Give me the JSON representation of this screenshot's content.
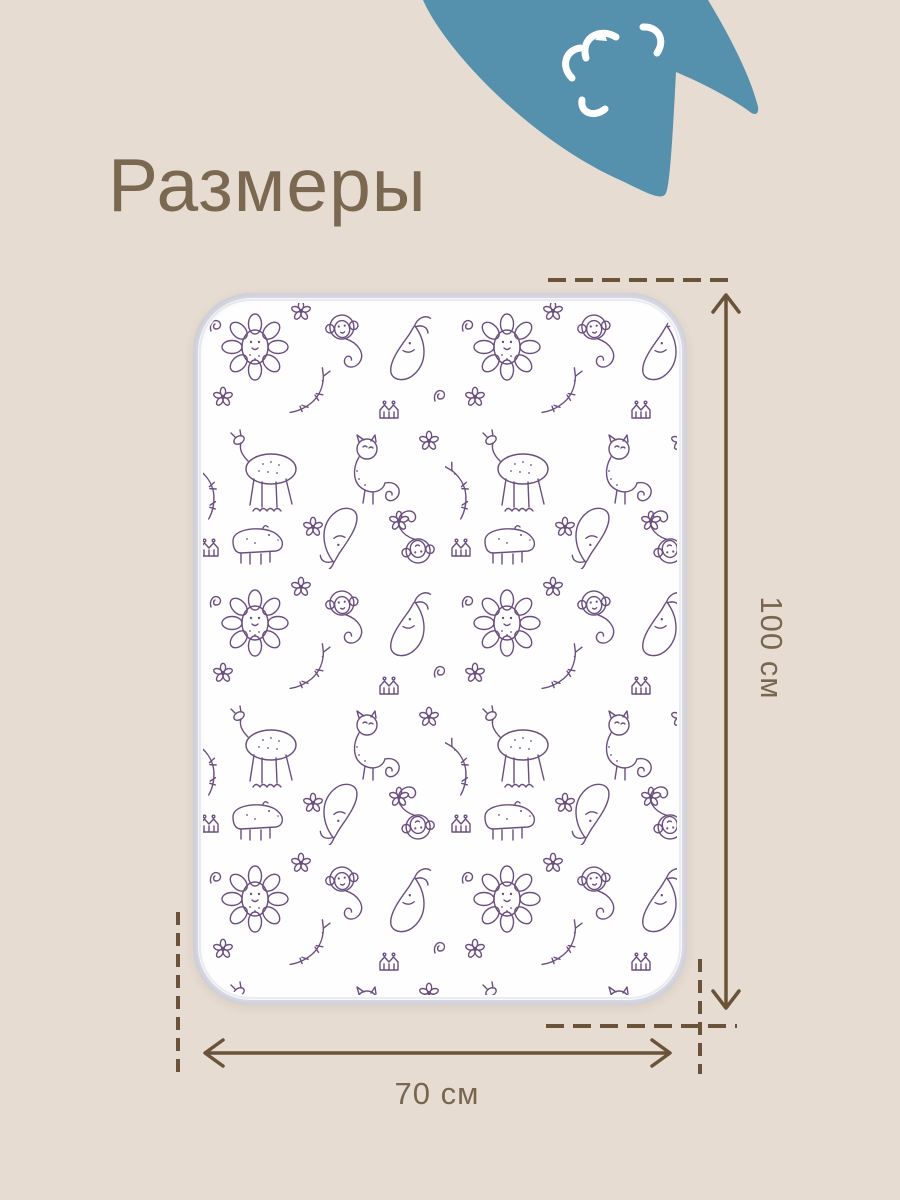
{
  "page": {
    "title": "Размеры"
  },
  "dimensions": {
    "height": {
      "label": "100 см",
      "value": 100,
      "unit": "см"
    },
    "width": {
      "label": "70 см",
      "value": 70,
      "unit": "см"
    }
  },
  "decor": {
    "corner_icon": "cat-silhouette-icon",
    "corner_face_icon": "sleeping-face-doodle-icon",
    "mat_pattern": "purple-animal-doodle-print",
    "mat_pattern_motifs": [
      "lion",
      "monkey",
      "whale",
      "deer",
      "cat",
      "hippo",
      "crocodile",
      "crown",
      "flower",
      "curl"
    ]
  },
  "colors": {
    "background": "#e7dcd2",
    "accent_blue": "#5590ad",
    "line_brown": "#6a5338",
    "title_brown": "#7b6851",
    "label_brown": "#79664f",
    "doodle_purple": "#6b4e81",
    "mat_white": "#fefefe",
    "mat_edge": "#dcdde6"
  }
}
